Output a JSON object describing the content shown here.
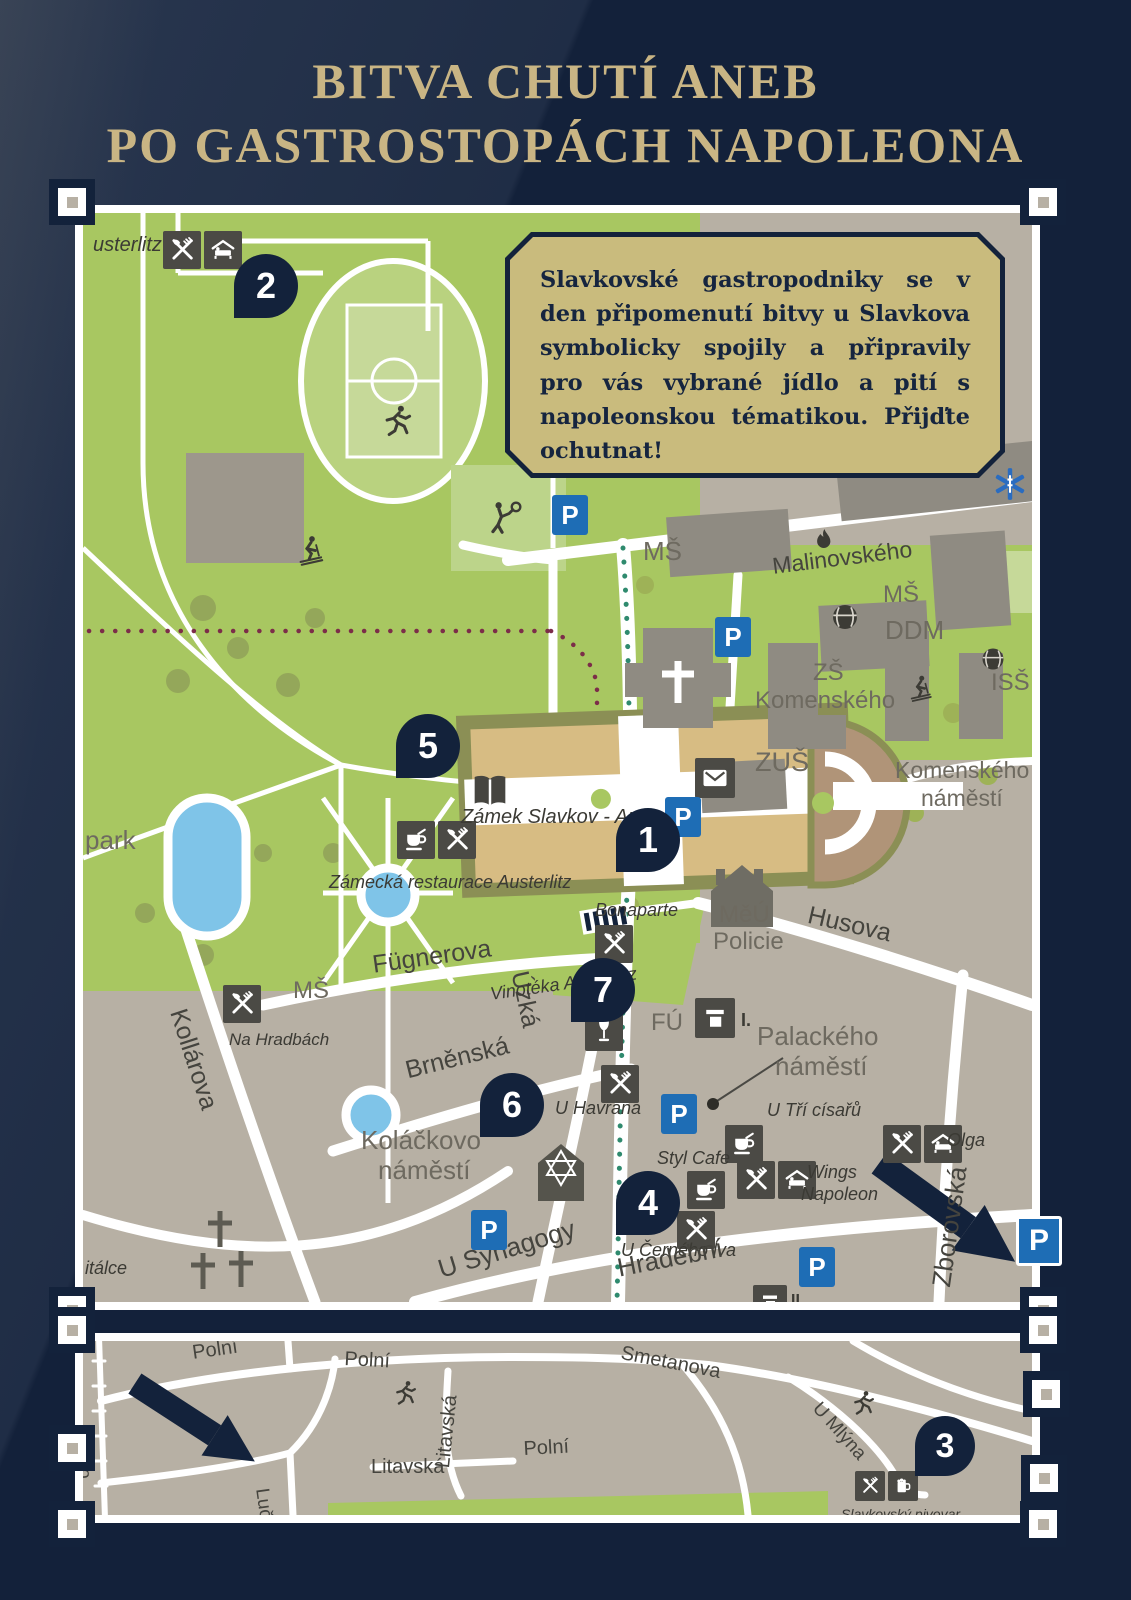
{
  "title": {
    "line1": "BITVA CHUTÍ ANEB",
    "line2": "PO GASTROSTOPÁCH NAPOLEONA"
  },
  "info_box": {
    "text": "Slavkovské gastropodniky se v den připomenutí bitvy u Slavkova symbolicky spojily a připravily pro vás vybrané jídlo a pití s napoleonskou tématikou. Přijďte ochutnat!"
  },
  "parking_label": "P",
  "colors": {
    "background_navy": "#13213a",
    "gold_title": "#c9b584",
    "map_green": "#a8c761",
    "map_gray": "#b7b0a4",
    "marker_navy": "#13223b",
    "parking_blue": "#1e6db5",
    "info_box_tan": "#c9bb7d",
    "castle_tan": "#d7bc83",
    "pond_blue": "#7fc4e8",
    "trail_teal": "#2f8a6e",
    "trail_maroon": "#7c2d49"
  },
  "main_map": {
    "marker_size": 64,
    "markers": [
      {
        "n": "2",
        "x": 183,
        "y": 73
      },
      {
        "n": "5",
        "x": 345,
        "y": 533
      },
      {
        "n": "1",
        "x": 565,
        "y": 627
      },
      {
        "n": "7",
        "x": 520,
        "y": 777
      },
      {
        "n": "6",
        "x": 429,
        "y": 892
      },
      {
        "n": "4",
        "x": 565,
        "y": 990
      }
    ],
    "parking": [
      {
        "x": 487,
        "y": 302
      },
      {
        "x": 650,
        "y": 424
      },
      {
        "x": 600,
        "y": 604
      },
      {
        "x": 596,
        "y": 901
      },
      {
        "x": 406,
        "y": 1017
      },
      {
        "x": 734,
        "y": 1054
      }
    ],
    "chips": [
      {
        "icons": [
          "rest",
          "bed"
        ],
        "x": 80,
        "y": 18
      },
      {
        "icons": [
          "cafe",
          "rest"
        ],
        "x": 314,
        "y": 608
      },
      {
        "icons": [
          "mail"
        ],
        "x": 612,
        "y": 545,
        "s": 40
      },
      {
        "icons": [
          "rest"
        ],
        "x": 512,
        "y": 712
      },
      {
        "icons": [
          "wine"
        ],
        "x": 502,
        "y": 800
      },
      {
        "icons": [
          "rest"
        ],
        "x": 518,
        "y": 852
      },
      {
        "icons": [
          "rest"
        ],
        "x": 140,
        "y": 772
      },
      {
        "icons": [
          "cafe"
        ],
        "x": 604,
        "y": 958
      },
      {
        "icons": [
          "cafe"
        ],
        "x": 642,
        "y": 912
      },
      {
        "icons": [
          "rest",
          "bed"
        ],
        "x": 654,
        "y": 948
      },
      {
        "icons": [
          "rest",
          "bed"
        ],
        "x": 800,
        "y": 912
      },
      {
        "icons": [
          "rest"
        ],
        "x": 594,
        "y": 998
      },
      {
        "icons": [
          "card"
        ],
        "x": 612,
        "y": 785,
        "s": 40
      },
      {
        "icons": [
          "card"
        ],
        "x": 670,
        "y": 1072,
        "s": 34
      }
    ],
    "figures": [
      {
        "i": "runner",
        "x": 296,
        "y": 190,
        "s": 36,
        "c": "#3c3b35"
      },
      {
        "i": "skier",
        "x": 210,
        "y": 320,
        "s": 34,
        "c": "#3c3b35"
      },
      {
        "i": "tennis",
        "x": 402,
        "y": 286,
        "s": 38,
        "c": "#3c3b35"
      },
      {
        "i": "book",
        "x": 384,
        "y": 556,
        "s": 46,
        "c": "#464540"
      },
      {
        "i": "flame",
        "x": 726,
        "y": 313,
        "s": 30,
        "c": "#3c3b35"
      },
      {
        "i": "globe",
        "x": 746,
        "y": 388,
        "s": 32,
        "c": "#3c3b35"
      },
      {
        "i": "globe",
        "x": 896,
        "y": 432,
        "s": 28,
        "c": "#3c3b35"
      },
      {
        "i": "skier",
        "x": 822,
        "y": 460,
        "s": 30,
        "c": "#3c3b35"
      },
      {
        "i": "star6",
        "x": 908,
        "y": 252,
        "s": 38,
        "c": "#2a6cc0"
      }
    ],
    "labels": [
      {
        "t": "usterlitz",
        "x": 10,
        "y": 22,
        "s": 20,
        "c": "poi"
      },
      {
        "t": "MŠ",
        "x": 560,
        "y": 325,
        "s": 26,
        "c": "area"
      },
      {
        "t": "Malinovského",
        "x": 688,
        "y": 342,
        "s": 23,
        "c": "street",
        "r": -7
      },
      {
        "t": "MŠ",
        "x": 800,
        "y": 370,
        "s": 24,
        "c": "area"
      },
      {
        "t": "DDM",
        "x": 802,
        "y": 404,
        "s": 26,
        "c": "area"
      },
      {
        "t": "ZŠ",
        "x": 730,
        "y": 448,
        "s": 24,
        "c": "area"
      },
      {
        "t": "Komenského",
        "x": 672,
        "y": 476,
        "s": 24,
        "c": "area"
      },
      {
        "t": "ISŠ",
        "x": 908,
        "y": 458,
        "s": 24,
        "c": "area"
      },
      {
        "t": "ZUŠ",
        "x": 672,
        "y": 536,
        "s": 27,
        "c": "area"
      },
      {
        "t": "Komenského",
        "x": 812,
        "y": 546,
        "s": 23,
        "c": "area"
      },
      {
        "t": "náměstí",
        "x": 838,
        "y": 574,
        "s": 23,
        "c": "area"
      },
      {
        "t": "park",
        "x": 2,
        "y": 614,
        "s": 26,
        "c": "area"
      },
      {
        "t": "Zámek Slavkov - Austerlitz",
        "x": 378,
        "y": 594,
        "s": 20,
        "c": "poi"
      },
      {
        "t": "Zámecká restaurace Austerlitz",
        "x": 246,
        "y": 660,
        "s": 18,
        "c": "poi"
      },
      {
        "t": "Bonaparte",
        "x": 512,
        "y": 688,
        "s": 18,
        "c": "poi"
      },
      {
        "t": "MěÚ",
        "x": 636,
        "y": 690,
        "s": 24,
        "c": "area"
      },
      {
        "t": "Policie",
        "x": 630,
        "y": 717,
        "s": 24,
        "c": "area"
      },
      {
        "t": "Husova",
        "x": 728,
        "y": 690,
        "s": 25,
        "c": "street",
        "r": 13
      },
      {
        "t": "Fügnerova",
        "x": 288,
        "y": 740,
        "s": 25,
        "c": "street",
        "r": -8
      },
      {
        "t": "Úzká",
        "x": 448,
        "y": 756,
        "s": 25,
        "c": "street",
        "r": 78
      },
      {
        "t": "MŠ",
        "x": 210,
        "y": 766,
        "s": 24,
        "c": "area"
      },
      {
        "t": "Na Hradbách",
        "x": 146,
        "y": 818,
        "s": 17,
        "c": "poi"
      },
      {
        "t": "Kollárova",
        "x": 106,
        "y": 793,
        "s": 25,
        "c": "street",
        "r": 72
      },
      {
        "t": "Vinotéka Austerlitz",
        "x": 406,
        "y": 772,
        "s": 18,
        "c": "poi",
        "r": -8
      },
      {
        "t": "FÚ",
        "x": 568,
        "y": 798,
        "s": 24,
        "c": "area"
      },
      {
        "t": "Brněnská",
        "x": 320,
        "y": 846,
        "s": 25,
        "c": "street",
        "r": -14
      },
      {
        "t": "U Havrana",
        "x": 472,
        "y": 886,
        "s": 18,
        "c": "poi"
      },
      {
        "t": "Palackého",
        "x": 674,
        "y": 810,
        "s": 26,
        "c": "area"
      },
      {
        "t": "náměstí",
        "x": 692,
        "y": 840,
        "s": 26,
        "c": "area"
      },
      {
        "t": "Koláčkovo",
        "x": 278,
        "y": 914,
        "s": 26,
        "c": "area"
      },
      {
        "t": "náměstí",
        "x": 295,
        "y": 944,
        "s": 26,
        "c": "area"
      },
      {
        "t": "Styl Cafe",
        "x": 574,
        "y": 936,
        "s": 18,
        "c": "poi"
      },
      {
        "t": "U Tří císařů",
        "x": 684,
        "y": 888,
        "s": 18,
        "c": "poi"
      },
      {
        "t": "Wings",
        "x": 724,
        "y": 950,
        "s": 18,
        "c": "poi"
      },
      {
        "t": "Napoleon",
        "x": 718,
        "y": 972,
        "s": 18,
        "c": "poi"
      },
      {
        "t": "Olga",
        "x": 864,
        "y": 918,
        "s": 18,
        "c": "poi"
      },
      {
        "t": "U Černého lva",
        "x": 538,
        "y": 1028,
        "s": 18,
        "c": "poi"
      },
      {
        "t": "U Synagogy",
        "x": 352,
        "y": 1044,
        "s": 26,
        "c": "street",
        "r": -17
      },
      {
        "t": "Hradební",
        "x": 532,
        "y": 1042,
        "s": 26,
        "c": "street",
        "r": -11
      },
      {
        "t": "Zborovská",
        "x": 845,
        "y": 1072,
        "s": 26,
        "c": "street",
        "r": -82
      },
      {
        "t": "itálce",
        "x": 2,
        "y": 1046,
        "s": 18,
        "c": "poi"
      },
      {
        "t": "riá",
        "x": 782,
        "y": -24,
        "s": 18,
        "c": "street",
        "r": 88
      },
      {
        "t": "I.",
        "x": 658,
        "y": 798,
        "s": 18,
        "c": "ip"
      },
      {
        "t": "II.",
        "x": 708,
        "y": 1080,
        "s": 16,
        "c": "ip"
      }
    ]
  },
  "strip_map": {
    "marker_size": 60,
    "markers": [
      {
        "n": "3",
        "x": 862,
        "y": 105
      }
    ],
    "parking": [],
    "chips": [
      {
        "icons": [
          "rest",
          "beer"
        ],
        "x": 772,
        "y": 130,
        "s": 30
      }
    ],
    "figures": [
      {
        "i": "runner",
        "x": 308,
        "y": 38,
        "s": 28,
        "c": "#3c3b35"
      },
      {
        "i": "runner",
        "x": 766,
        "y": 48,
        "s": 28,
        "c": "#3c3b35"
      }
    ],
    "labels": [
      {
        "t": "Polní",
        "x": 108,
        "y": 2,
        "s": 20,
        "c": "street",
        "r": -8
      },
      {
        "t": "Polní",
        "x": 262,
        "y": 8,
        "s": 20,
        "c": "street",
        "r": 3
      },
      {
        "t": "Smetanova",
        "x": 540,
        "y": 2,
        "s": 20,
        "c": "street",
        "r": 11
      },
      {
        "t": "Litavská",
        "x": 350,
        "y": 126,
        "s": 20,
        "c": "street",
        "r": -84
      },
      {
        "t": "Polní",
        "x": 440,
        "y": 98,
        "s": 20,
        "c": "street",
        "r": -3
      },
      {
        "t": "Litavská",
        "x": 288,
        "y": 116,
        "s": 20,
        "c": "street"
      },
      {
        "t": "Luční",
        "x": 188,
        "y": 146,
        "s": 19,
        "c": "street",
        "r": 82
      },
      {
        "t": "Česko",
        "x": 8,
        "y": 86,
        "s": 18,
        "c": "street",
        "r": 86
      },
      {
        "t": "U Mlýna",
        "x": 740,
        "y": 58,
        "s": 19,
        "c": "street",
        "r": 48
      },
      {
        "t": "Slavkovský pivovar",
        "x": 758,
        "y": 166,
        "s": 14,
        "c": "poi"
      }
    ]
  },
  "outer_parking": {
    "label": "P"
  }
}
